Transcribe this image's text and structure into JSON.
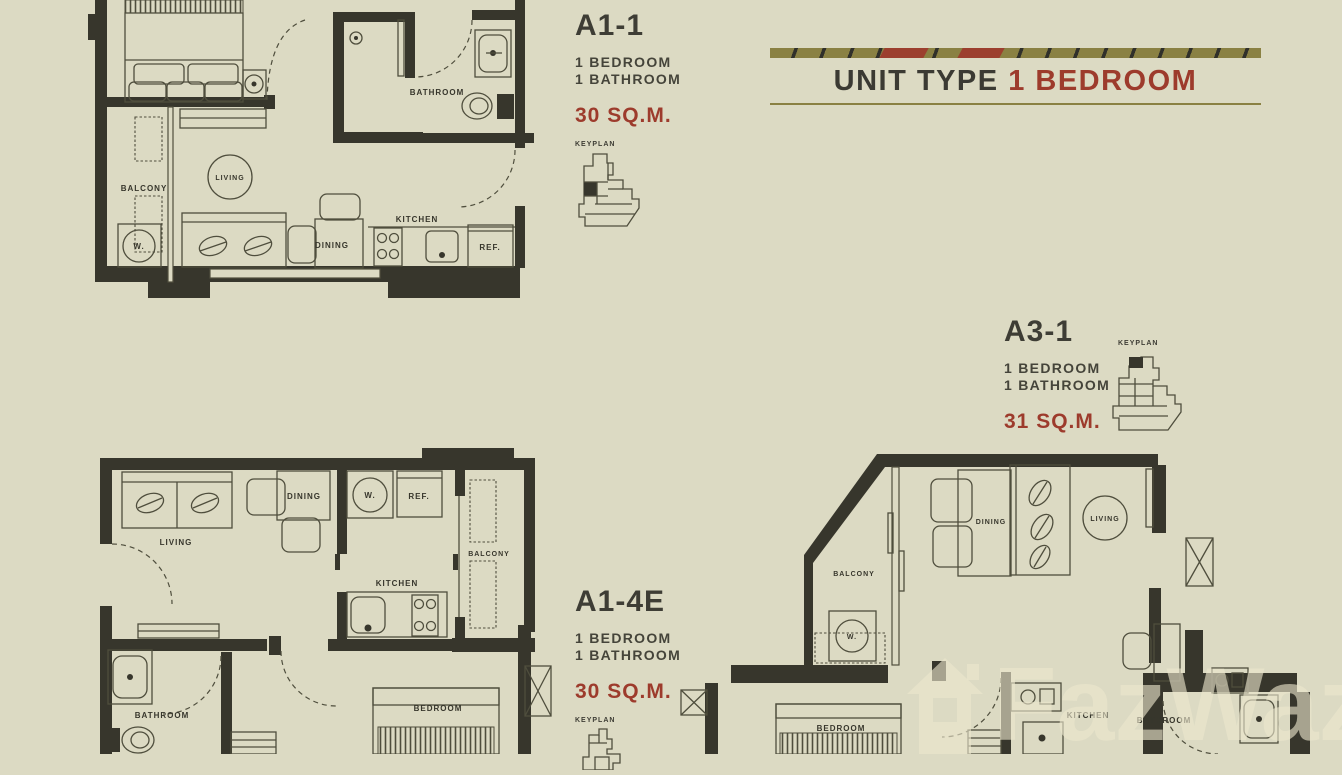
{
  "header": {
    "prefix": "UNIT TYPE",
    "accent": "1 BEDROOM"
  },
  "watermark": {
    "text": "FazWaz"
  },
  "units": {
    "a1_1": {
      "code": "A1-1",
      "bed": "1 BEDROOM",
      "bath": "1 BATHROOM",
      "area": "30 SQ.M.",
      "keyplan": "KEYPLAN"
    },
    "a1_4e": {
      "code": "A1-4E",
      "bed": "1 BEDROOM",
      "bath": "1 BATHROOM",
      "area": "30 SQ.M.",
      "keyplan": "KEYPLAN"
    },
    "a3_1": {
      "code": "A3-1",
      "bed": "1 BEDROOM",
      "bath": "1 BATHROOM",
      "area": "31 SQ.M.",
      "keyplan": "KEYPLAN"
    }
  },
  "rooms": {
    "p1": {
      "living": "LIVING",
      "balcony": "BALCONY",
      "washer": "W.",
      "dining": "DINING",
      "kitchen": "KITCHEN",
      "ref": "REF.",
      "bathroom": "BATHROOM"
    },
    "p2": {
      "living": "LIVING",
      "dining": "DINING",
      "washer": "W.",
      "ref": "REF.",
      "balcony": "BALCONY",
      "kitchen": "KITCHEN",
      "bathroom": "BATHROOM",
      "bedroom": "BEDROOM"
    },
    "p3": {
      "balcony": "BALCONY",
      "washer": "W.",
      "dining": "DINING",
      "living": "LIVING",
      "bedroom": "BEDROOM",
      "kitchen": "KITCHEN",
      "bathroom": "BATHROOM"
    }
  },
  "colors": {
    "background": "#dcdac3",
    "ink": "#37362c",
    "accent_red": "#9d3b2c",
    "olive": "#8a8143"
  }
}
